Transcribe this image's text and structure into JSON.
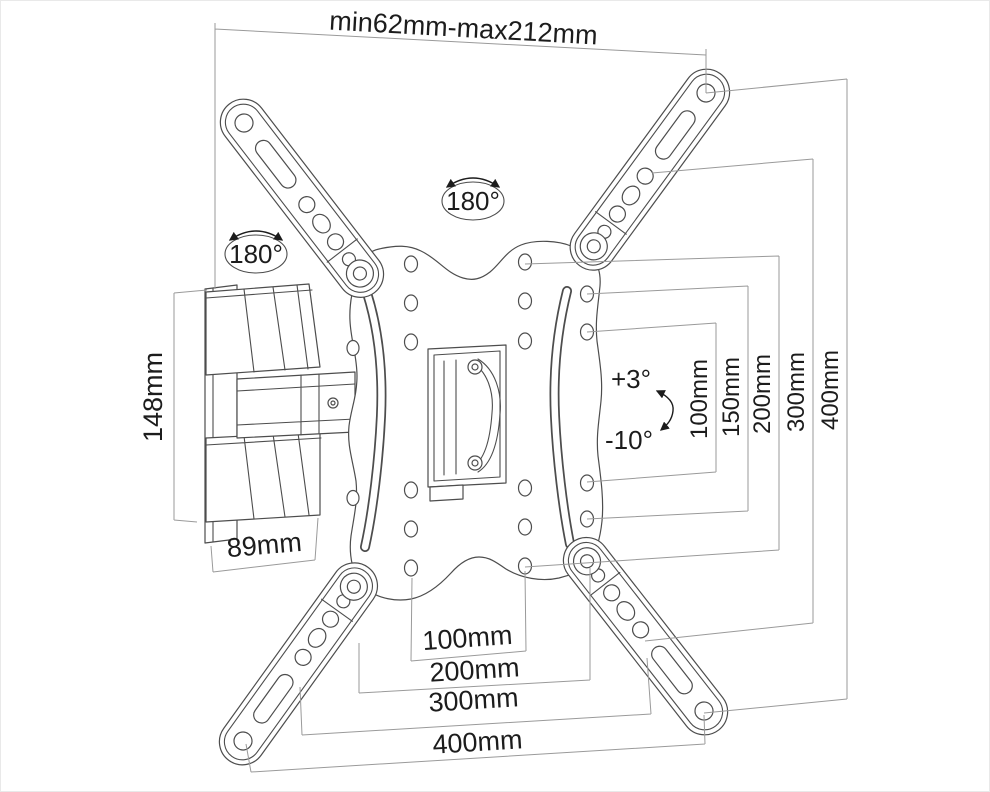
{
  "diagram": {
    "kind": "tv-wall-mount-technical-drawing",
    "colors": {
      "background": "#ffffff",
      "part_line": "#4d4d4d",
      "dimension_line": "#9a9a9a",
      "text": "#1c1c1c"
    },
    "icons": {
      "rotation_arrow": "double-headed curved arrow",
      "tilt_arrow": "double-headed curved arrow"
    },
    "labels": {
      "depth_range": "min62mm-max212mm",
      "bracket_height": "148mm",
      "bracket_depth": "89mm",
      "swivel_top": "180°",
      "swivel_left": "180°",
      "tilt_up": "+3°",
      "tilt_down": "-10°",
      "vertical_spacings": [
        "100mm",
        "150mm",
        "200mm",
        "300mm",
        "400mm"
      ],
      "horizontal_spacings": [
        "100mm",
        "200mm",
        "300mm",
        "400mm"
      ]
    }
  }
}
